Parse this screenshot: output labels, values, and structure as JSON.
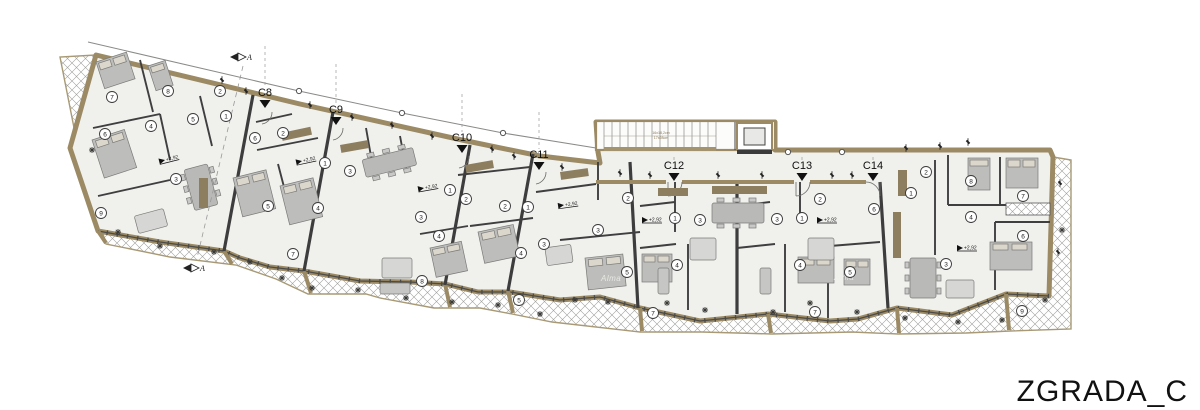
{
  "title": "ZGRADA_C",
  "section_marker": {
    "label": "A"
  },
  "floor_elevation_label": "+2,92",
  "stairs_note": {
    "line1": "16x18,2cm",
    "line2": "17x28cm"
  },
  "watermark_label": "Alma",
  "watermarks": [
    {
      "x": 601,
      "y": 281
    },
    {
      "x": 834,
      "y": 280
    },
    {
      "x": 483,
      "y": 283
    }
  ],
  "units": [
    {
      "label": "C8",
      "x": 265,
      "y": 96,
      "ly": 46
    },
    {
      "label": "C9",
      "x": 336,
      "y": 113,
      "ly": 64
    },
    {
      "label": "C10",
      "x": 462,
      "y": 141,
      "ly": 94
    },
    {
      "label": "C11",
      "x": 539,
      "y": 158,
      "ly": 112
    },
    {
      "label": "C12",
      "x": 674,
      "y": 169,
      "ly": 157
    },
    {
      "label": "C13",
      "x": 802,
      "y": 169,
      "ly": 157
    },
    {
      "label": "C14",
      "x": 873,
      "y": 169,
      "ly": 157
    }
  ],
  "elevation_markers": [
    {
      "x": 165,
      "y": 160,
      "rot": -14
    },
    {
      "x": 302,
      "y": 161,
      "rot": -12
    },
    {
      "x": 424,
      "y": 188,
      "rot": -10
    },
    {
      "x": 564,
      "y": 205,
      "rot": -8
    },
    {
      "x": 648,
      "y": 220,
      "rot": 0
    },
    {
      "x": 823,
      "y": 220,
      "rot": 0
    },
    {
      "x": 963,
      "y": 248,
      "rot": 0
    }
  ],
  "room_circles": [
    {
      "n": "7",
      "x": 112,
      "y": 97
    },
    {
      "n": "8",
      "x": 168,
      "y": 91
    },
    {
      "n": "2",
      "x": 220,
      "y": 91
    },
    {
      "n": "1",
      "x": 226,
      "y": 116
    },
    {
      "n": "5",
      "x": 193,
      "y": 119
    },
    {
      "n": "4",
      "x": 151,
      "y": 126
    },
    {
      "n": "6",
      "x": 105,
      "y": 134
    },
    {
      "n": "3",
      "x": 176,
      "y": 179
    },
    {
      "n": "9",
      "x": 101,
      "y": 213
    },
    {
      "n": "6",
      "x": 255,
      "y": 138
    },
    {
      "n": "2",
      "x": 283,
      "y": 133
    },
    {
      "n": "1",
      "x": 325,
      "y": 163
    },
    {
      "n": "3",
      "x": 350,
      "y": 171
    },
    {
      "n": "5",
      "x": 268,
      "y": 206
    },
    {
      "n": "4",
      "x": 318,
      "y": 208
    },
    {
      "n": "7",
      "x": 293,
      "y": 254
    },
    {
      "n": "1",
      "x": 450,
      "y": 190
    },
    {
      "n": "2",
      "x": 466,
      "y": 199
    },
    {
      "n": "3",
      "x": 421,
      "y": 217
    },
    {
      "n": "4",
      "x": 439,
      "y": 236
    },
    {
      "n": "8",
      "x": 422,
      "y": 281
    },
    {
      "n": "2",
      "x": 505,
      "y": 206
    },
    {
      "n": "1",
      "x": 528,
      "y": 207
    },
    {
      "n": "3",
      "x": 544,
      "y": 244
    },
    {
      "n": "4",
      "x": 521,
      "y": 253
    },
    {
      "n": "5",
      "x": 519,
      "y": 300
    },
    {
      "n": "2",
      "x": 628,
      "y": 198
    },
    {
      "n": "3",
      "x": 598,
      "y": 230
    },
    {
      "n": "5",
      "x": 627,
      "y": 272
    },
    {
      "n": "1",
      "x": 675,
      "y": 218
    },
    {
      "n": "3",
      "x": 700,
      "y": 220
    },
    {
      "n": "4",
      "x": 677,
      "y": 265
    },
    {
      "n": "7",
      "x": 653,
      "y": 313
    },
    {
      "n": "3",
      "x": 777,
      "y": 219
    },
    {
      "n": "1",
      "x": 802,
      "y": 218
    },
    {
      "n": "2",
      "x": 820,
      "y": 199
    },
    {
      "n": "6",
      "x": 874,
      "y": 209
    },
    {
      "n": "4",
      "x": 800,
      "y": 265
    },
    {
      "n": "5",
      "x": 850,
      "y": 272
    },
    {
      "n": "7",
      "x": 815,
      "y": 312
    },
    {
      "n": "2",
      "x": 926,
      "y": 172
    },
    {
      "n": "1",
      "x": 911,
      "y": 193
    },
    {
      "n": "8",
      "x": 971,
      "y": 181
    },
    {
      "n": "7",
      "x": 1023,
      "y": 196
    },
    {
      "n": "4",
      "x": 971,
      "y": 217
    },
    {
      "n": "6",
      "x": 1023,
      "y": 236
    },
    {
      "n": "3",
      "x": 946,
      "y": 264
    },
    {
      "n": "9",
      "x": 1022,
      "y": 311
    }
  ],
  "colors": {
    "wall_tan": "#9b8a64",
    "wall_dark": "#57472f",
    "floor": "#f0f0ed",
    "ink": "#1d1d1d",
    "hatch_line": "#a0a09e",
    "furniture": "#bdbdbb",
    "pillow": "#dcd7cc",
    "kitchen": "#8d7e60"
  }
}
